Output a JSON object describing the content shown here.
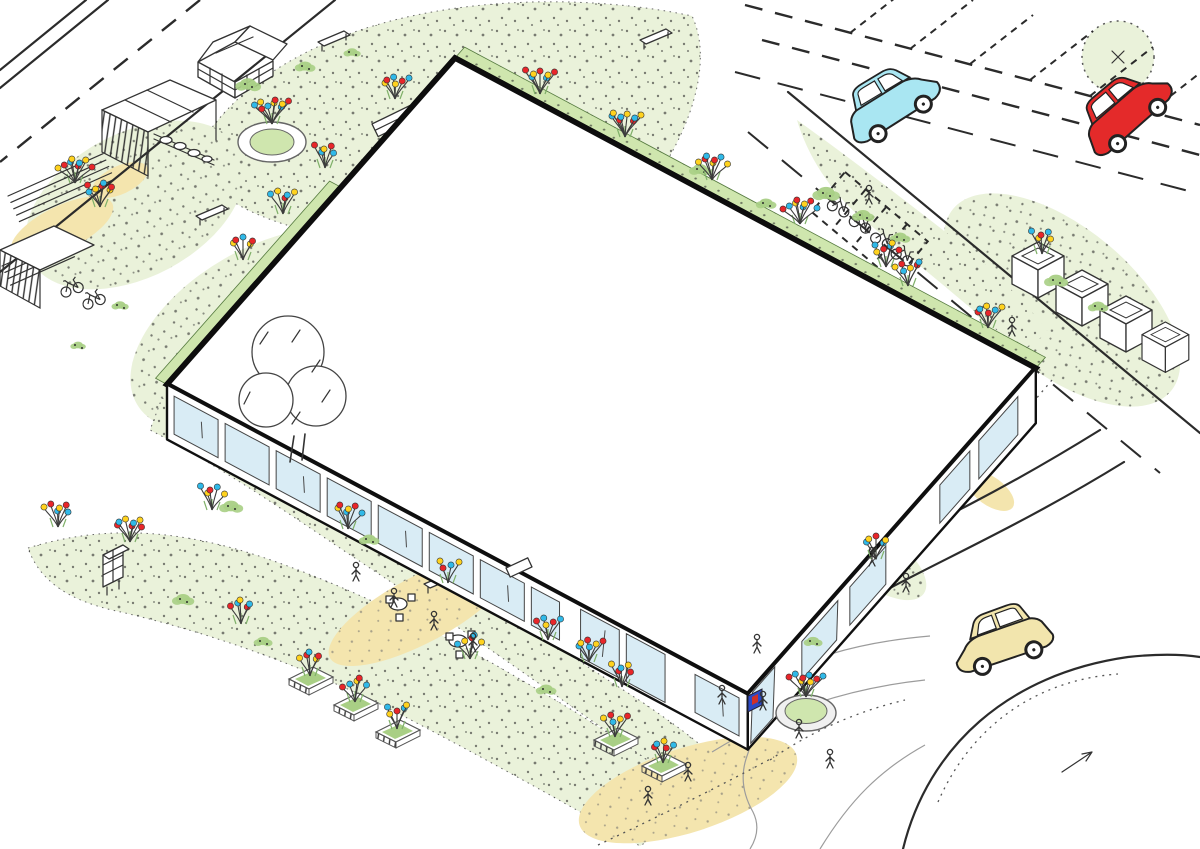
{
  "palette": {
    "ink": "#2b2b2b",
    "lawn": "#eaf2da",
    "veg": "#a9cf85",
    "veg2": "#cfe6ae",
    "leaf": "#7fb069",
    "sand": "#f4e5ae",
    "glass": "#d9ecf5",
    "shelf": "#cde7f2",
    "flower_red": "#e8262a",
    "flower_blue": "#30b9e8",
    "flower_yellow": "#ffd21e",
    "sign_blue": "#2b49c6",
    "sign_red": "#d03028"
  },
  "scene": {
    "cars": [
      {
        "name": "car-driving-cyan",
        "color": "#a9e6f2",
        "x": 893,
        "y": 106,
        "rot": -31,
        "flip": false
      },
      {
        "name": "car-parked-red",
        "color": "#e42a2a",
        "x": 1128,
        "y": 114,
        "rot": -40,
        "flip": false
      },
      {
        "name": "car-dropoff-yellow",
        "color": "#f2e5ad",
        "x": 1003,
        "y": 644,
        "rot": -20,
        "flip": true
      }
    ],
    "gym_bench_colors": [
      "#45c8e8",
      "#e8392f",
      "#45c8e8",
      "#e8392f",
      "#45c8e8",
      "#45c8e8"
    ],
    "flower_clusters": [
      [
        75,
        183,
        8
      ],
      [
        100,
        207,
        7
      ],
      [
        272,
        124,
        9
      ],
      [
        395,
        99,
        6
      ],
      [
        325,
        168,
        5
      ],
      [
        283,
        214,
        5
      ],
      [
        243,
        260,
        5
      ],
      [
        540,
        94,
        7
      ],
      [
        625,
        137,
        8
      ],
      [
        712,
        180,
        7
      ],
      [
        800,
        224,
        8
      ],
      [
        886,
        267,
        6
      ],
      [
        908,
        286,
        6
      ],
      [
        988,
        328,
        6
      ],
      [
        1042,
        254,
        5
      ],
      [
        58,
        527,
        6
      ],
      [
        130,
        542,
        7
      ],
      [
        212,
        510,
        5
      ],
      [
        348,
        529,
        6
      ],
      [
        241,
        624,
        5
      ],
      [
        470,
        659,
        5
      ],
      [
        448,
        583,
        4
      ],
      [
        548,
        640,
        5
      ],
      [
        589,
        662,
        6
      ],
      [
        622,
        687,
        5
      ],
      [
        806,
        697,
        8
      ],
      [
        876,
        559,
        5
      ]
    ],
    "planter_boxes": [
      [
        307,
        676
      ],
      [
        352,
        702
      ],
      [
        394,
        729
      ],
      [
        612,
        737
      ],
      [
        660,
        763
      ]
    ],
    "shrubs": [
      [
        248,
        84,
        15
      ],
      [
        305,
        66,
        12
      ],
      [
        352,
        52,
        10
      ],
      [
        826,
        193,
        16
      ],
      [
        863,
        215,
        13
      ],
      [
        900,
        237,
        12
      ],
      [
        700,
        169,
        13
      ],
      [
        766,
        203,
        12
      ],
      [
        231,
        506,
        14
      ],
      [
        369,
        539,
        12
      ],
      [
        183,
        599,
        13
      ],
      [
        263,
        641,
        11
      ],
      [
        546,
        689,
        12
      ],
      [
        813,
        641,
        11
      ],
      [
        1056,
        280,
        14
      ],
      [
        1098,
        306,
        12
      ],
      [
        120,
        305,
        10
      ],
      [
        78,
        345,
        9
      ]
    ],
    "people": [
      [
        763,
        706
      ],
      [
        799,
        734
      ],
      [
        830,
        764
      ],
      [
        688,
        777
      ],
      [
        648,
        801
      ],
      [
        872,
        562
      ],
      [
        906,
        588
      ],
      [
        1012,
        332
      ],
      [
        869,
        200
      ],
      [
        356,
        577
      ],
      [
        394,
        603
      ],
      [
        434,
        626
      ],
      [
        473,
        648
      ],
      [
        757,
        649
      ],
      [
        722,
        700
      ]
    ]
  }
}
